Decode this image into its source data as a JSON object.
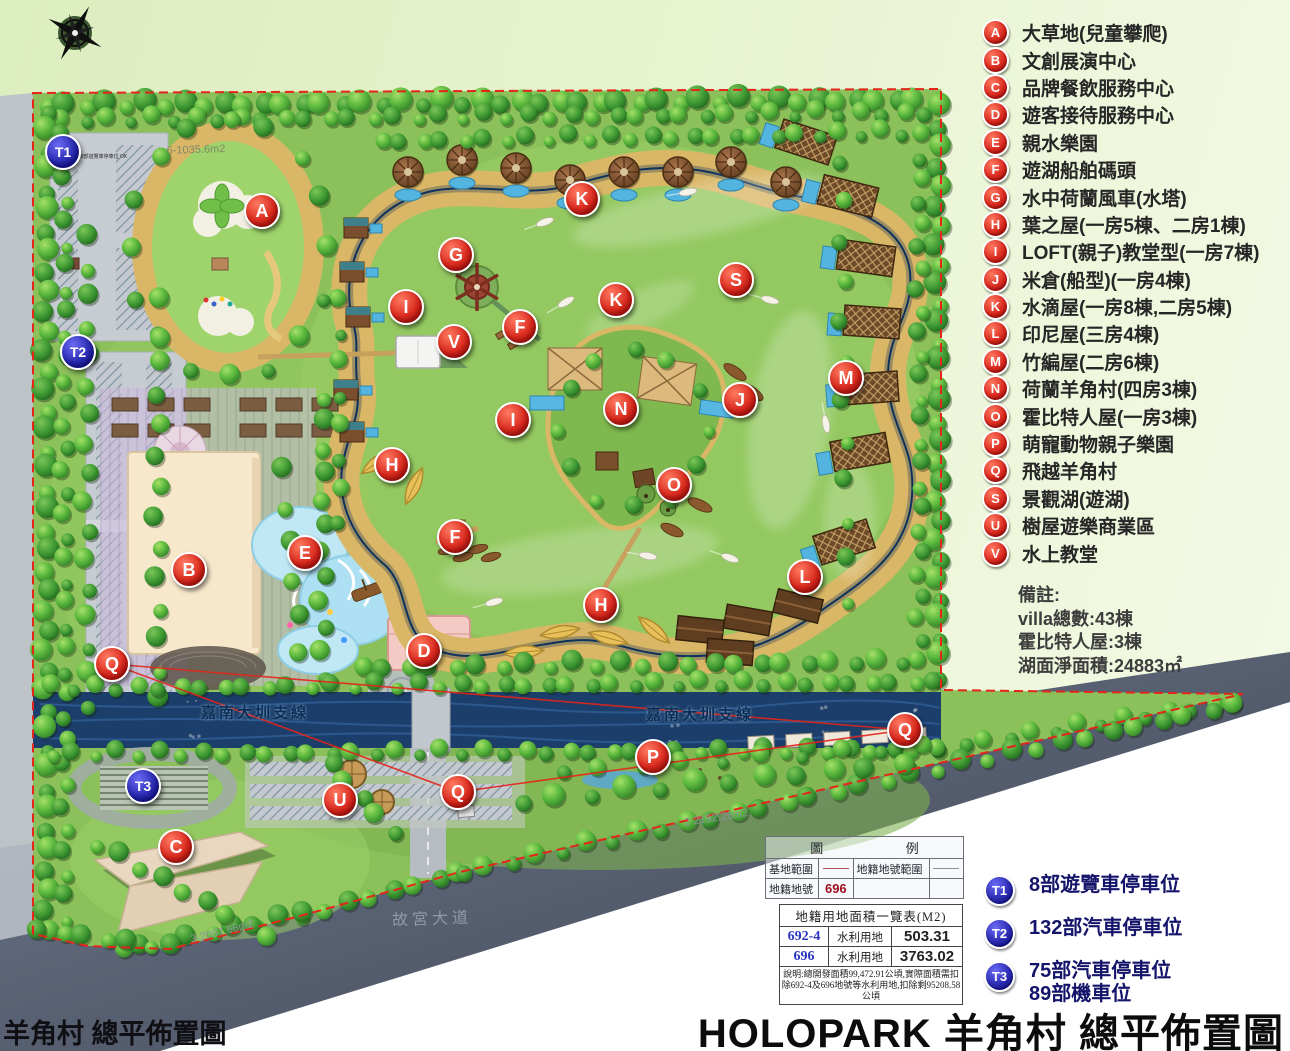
{
  "title": {
    "main": "HOLOPARK 羊角村 總平佈置圖",
    "footer_left": "羊角村 總平佈置圖"
  },
  "legend": {
    "items": [
      {
        "letter": "A",
        "label": "大草地(兒童攀爬)"
      },
      {
        "letter": "B",
        "label": "文創展演中心"
      },
      {
        "letter": "C",
        "label": "品牌餐飲服務中心"
      },
      {
        "letter": "D",
        "label": "遊客接待服務中心"
      },
      {
        "letter": "E",
        "label": "親水樂園"
      },
      {
        "letter": "F",
        "label": "遊湖船舶碼頭"
      },
      {
        "letter": "G",
        "label": "水中荷蘭風車(水塔)"
      },
      {
        "letter": "H",
        "label": "葉之屋(一房5棟、二房1棟)"
      },
      {
        "letter": "I",
        "label": "LOFT(親子)教堂型(一房7棟)"
      },
      {
        "letter": "J",
        "label": "米倉(船型)(一房4棟)"
      },
      {
        "letter": "K",
        "label": "水滴屋(一房8棟,二房5棟)"
      },
      {
        "letter": "L",
        "label": "印尼屋(三房4棟)"
      },
      {
        "letter": "M",
        "label": "竹編屋(二房6棟)"
      },
      {
        "letter": "N",
        "label": "荷蘭羊角村(四房3棟)"
      },
      {
        "letter": "O",
        "label": "霍比特人屋(一房3棟)"
      },
      {
        "letter": "P",
        "label": "萌寵動物親子樂園"
      },
      {
        "letter": "Q",
        "label": "飛越羊角村"
      },
      {
        "letter": "S",
        "label": "景觀湖(遊湖)"
      },
      {
        "letter": "U",
        "label": "樹屋遊樂商業區"
      },
      {
        "letter": "V",
        "label": "水上教堂"
      }
    ]
  },
  "notes": {
    "heading": "備註:",
    "lines": [
      "villa總數:43棟",
      "霍比特人屋:3棟",
      "湖面淨面積:24883㎡"
    ]
  },
  "parking_legend": {
    "items": [
      {
        "code": "T1",
        "lines": [
          "8部遊覽車停車位"
        ]
      },
      {
        "code": "T2",
        "lines": [
          "132部汽車停車位"
        ]
      },
      {
        "code": "T3",
        "lines": [
          "75部汽車停車位",
          "89部機車位"
        ]
      }
    ]
  },
  "legend_table": {
    "title_left": "圖",
    "title_right": "例",
    "r1c1": "基地範圍",
    "r1c3": "地籍地號範圍",
    "r2c1": "地籍地號",
    "r2c2": "696"
  },
  "area_table": {
    "title": "地籍用地面積一覽表(M2)",
    "rows": [
      {
        "lot": "692-4",
        "use": "水利用地",
        "area": "503.31"
      },
      {
        "lot": "696",
        "use": "水利用地",
        "area": "3763.02"
      }
    ],
    "note": "說明:總開發面積99,472.91公頃,實際面積需扣除692-4及696地號等水利用地,扣除剩95208.58公頃"
  },
  "map": {
    "markers": [
      {
        "letter": "A",
        "x": 262,
        "y": 211
      },
      {
        "letter": "G",
        "x": 456,
        "y": 255
      },
      {
        "letter": "K",
        "x": 582,
        "y": 199
      },
      {
        "letter": "S",
        "x": 736,
        "y": 280
      },
      {
        "letter": "I",
        "x": 406,
        "y": 307
      },
      {
        "letter": "K",
        "x": 616,
        "y": 300
      },
      {
        "letter": "V",
        "x": 454,
        "y": 342
      },
      {
        "letter": "F",
        "x": 520,
        "y": 327
      },
      {
        "letter": "M",
        "x": 846,
        "y": 378
      },
      {
        "letter": "J",
        "x": 740,
        "y": 400
      },
      {
        "letter": "N",
        "x": 621,
        "y": 409
      },
      {
        "letter": "I",
        "x": 513,
        "y": 420
      },
      {
        "letter": "H",
        "x": 392,
        "y": 465
      },
      {
        "letter": "O",
        "x": 674,
        "y": 485
      },
      {
        "letter": "E",
        "x": 305,
        "y": 553
      },
      {
        "letter": "B",
        "x": 189,
        "y": 570
      },
      {
        "letter": "F",
        "x": 455,
        "y": 537
      },
      {
        "letter": "L",
        "x": 805,
        "y": 577
      },
      {
        "letter": "H",
        "x": 601,
        "y": 605
      },
      {
        "letter": "Q",
        "x": 112,
        "y": 664
      },
      {
        "letter": "D",
        "x": 424,
        "y": 651
      },
      {
        "letter": "P",
        "x": 653,
        "y": 757
      },
      {
        "letter": "Q",
        "x": 905,
        "y": 730
      },
      {
        "letter": "U",
        "x": 340,
        "y": 800
      },
      {
        "letter": "Q",
        "x": 458,
        "y": 792
      },
      {
        "letter": "C",
        "x": 176,
        "y": 847
      }
    ],
    "t_markers": [
      {
        "code": "T1",
        "x": 63,
        "y": 152
      },
      {
        "code": "T2",
        "x": 78,
        "y": 352
      },
      {
        "code": "T3",
        "x": 143,
        "y": 786
      }
    ],
    "labels": [
      {
        "text": "嘉南大圳支線",
        "x": 255,
        "y": 712,
        "rot": 0,
        "cls": "lbl-canal"
      },
      {
        "text": "嘉南大圳支線",
        "x": 700,
        "y": 714,
        "rot": 0,
        "cls": "lbl-canal"
      },
      {
        "text": "故宮大道",
        "x": 432,
        "y": 917,
        "rot": -2,
        "cls": "lbl-road"
      },
      {
        "text": "6-1035.6m2",
        "x": 196,
        "y": 150,
        "rot": -2,
        "cls": "lbl-area"
      },
      {
        "text": "3-2097.66m2",
        "x": 222,
        "y": 932,
        "rot": -14,
        "cls": "lbl-area-dark"
      },
      {
        "text": "2-2192.26m2",
        "x": 716,
        "y": 818,
        "rot": -9,
        "cls": "lbl-area-dark"
      },
      {
        "text": "8部遊覽車停車位 OK",
        "x": 104,
        "y": 157,
        "rot": 0,
        "cls": "lbl-tiny"
      }
    ]
  },
  "colors": {
    "marker_red": "#d92a1e",
    "marker_blue": "#2a2ab0",
    "lake_deep": "#123e74",
    "sand": "#d9b766",
    "boundary_red": "#e3251a"
  }
}
